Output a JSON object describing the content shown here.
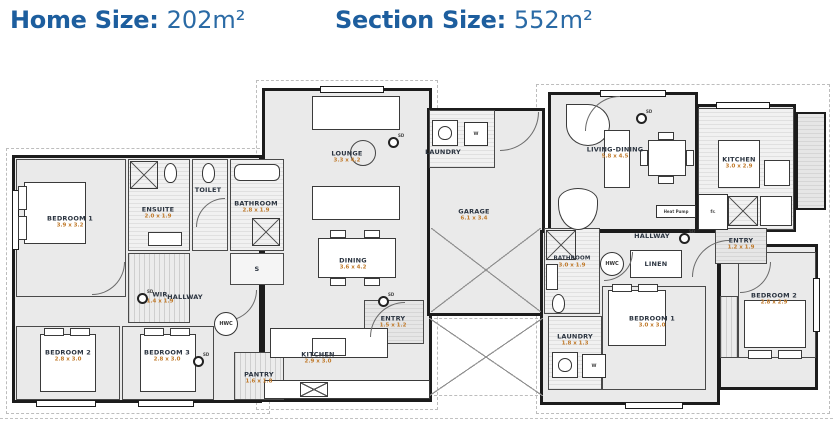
{
  "header": {
    "home_size_label": "Home Size:",
    "home_size_value": "202m²",
    "section_size_label": "Section Size:",
    "section_size_value": "552m²"
  },
  "colors": {
    "accent_blue": "#1d5e9e",
    "room_name": "#2b3440",
    "dimension_text": "#c07a2b",
    "wall": "#1c1c1c"
  },
  "floorplan": {
    "left_unit": {
      "bedroom1": {
        "name": "BEDROOM 1",
        "dims": "3.9 x 3.2"
      },
      "ensuite": {
        "name": "ENSUITE",
        "dims": "2.0 x 1.9"
      },
      "toilet": {
        "name": "TOILET"
      },
      "bathroom": {
        "name": "BATHROOM",
        "dims": "2.8 x 1.9"
      },
      "wir": {
        "name": "WIR",
        "dims": "1.4 x 1.9"
      },
      "storage": {
        "name": "S"
      },
      "hallway": {
        "name": "HALLWAY"
      },
      "bedroom2": {
        "name": "BEDROOM 2",
        "dims": "2.8 x 3.0"
      },
      "bedroom3": {
        "name": "BEDROOM 3",
        "dims": "2.8 x 3.0"
      },
      "pantry": {
        "name": "PANTRY",
        "dims": "1.6 x 1.8"
      },
      "kitchen": {
        "name": "KITCHEN",
        "dims": "2.9 x 3.0"
      },
      "dining": {
        "name": "DINING",
        "dims": "3.6 x 4.2"
      },
      "lounge": {
        "name": "LOUNGE",
        "dims": "3.3 x 4.2"
      },
      "entry": {
        "name": "ENTRY",
        "dims": "1.5 x 1.2"
      },
      "laundry": {
        "name": "LAUNDRY"
      },
      "garage": {
        "name": "GARAGE",
        "dims": "6.1 x 3.4"
      }
    },
    "right_unit": {
      "living_dining": {
        "name": "LIVING-DINING",
        "dims": "5.8 x 4.5"
      },
      "kitchen": {
        "name": "KITCHEN",
        "dims": "3.0 x 2.9"
      },
      "hallway": {
        "name": "HALLWAY"
      },
      "entry": {
        "name": "ENTRY",
        "dims": "1.2 x 1.9"
      },
      "bathroom": {
        "name": "BATHROOM",
        "dims": "3.0 x 1.9"
      },
      "linen": {
        "name": "LINEN"
      },
      "bedroom1": {
        "name": "BEDROOM 1",
        "dims": "3.0 x 3.0"
      },
      "laundry": {
        "name": "LAUNDRY",
        "dims": "1.8 x 1.3"
      },
      "bedroom2": {
        "name": "BEDROOM 2",
        "dims": "2.8 x 2.9"
      }
    },
    "annotations": {
      "sd": "SD",
      "hwc": "HWC",
      "heat_pump": "Heat Pump",
      "fridge": "fr.",
      "washer": "W"
    }
  }
}
